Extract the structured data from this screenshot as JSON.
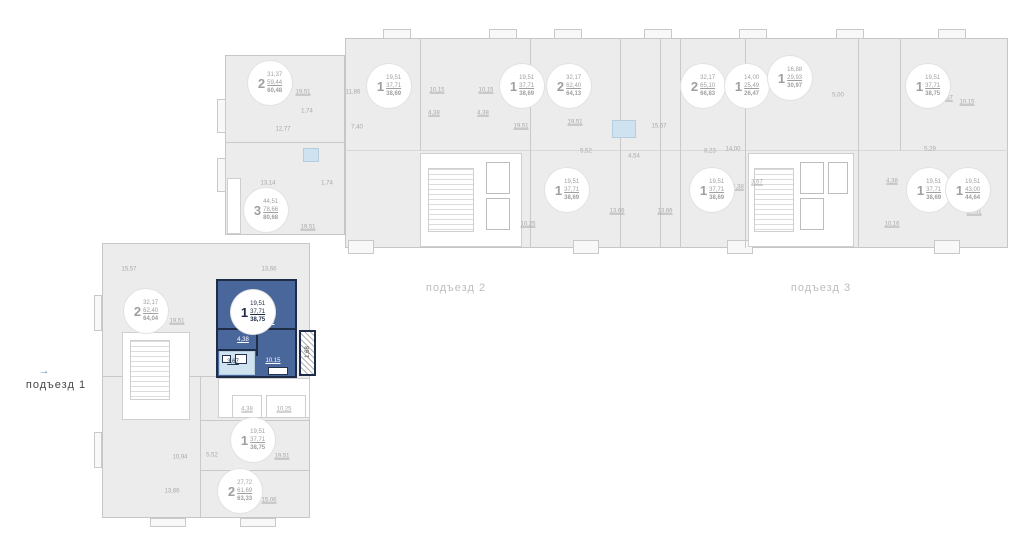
{
  "entrances": [
    {
      "label": "подъезд 1"
    },
    {
      "label": "подъезд 2"
    },
    {
      "label": "подъезд 3"
    }
  ],
  "arrow_icon": "→",
  "badges": [
    {
      "rooms": "2",
      "v1": "31,37",
      "v2": "59,44",
      "v3": "60,48"
    },
    {
      "rooms": "1",
      "v1": "19,51",
      "v2": "37,71",
      "v3": "38,69"
    },
    {
      "rooms": "1",
      "v1": "19,51",
      "v2": "37,71",
      "v3": "38,69"
    },
    {
      "rooms": "2",
      "v1": "32,17",
      "v2": "62,40",
      "v3": "64,13"
    },
    {
      "rooms": "2",
      "v1": "32,17",
      "v2": "65,10",
      "v3": "66,83"
    },
    {
      "rooms": "1",
      "v1": "14,00",
      "v2": "25,49",
      "v3": "26,47"
    },
    {
      "rooms": "1",
      "v1": "16,88",
      "v2": "29,93",
      "v3": "30,97"
    },
    {
      "rooms": "1",
      "v1": "19,51",
      "v2": "37,71",
      "v3": "38,75"
    },
    {
      "rooms": "3",
      "v1": "44,51",
      "v2": "78,66",
      "v3": "80,68"
    },
    {
      "rooms": "1",
      "v1": "19,51",
      "v2": "37,71",
      "v3": "38,69"
    },
    {
      "rooms": "1",
      "v1": "19,51",
      "v2": "37,71",
      "v3": "38,69"
    },
    {
      "rooms": "1",
      "v1": "19,51",
      "v2": "37,71",
      "v3": "38,69"
    },
    {
      "rooms": "1",
      "v1": "19,51",
      "v2": "43,00",
      "v3": "44,64"
    },
    {
      "rooms": "2",
      "v1": "32,17",
      "v2": "62,40",
      "v3": "64,04"
    },
    {
      "rooms": "1",
      "v1": "19,51",
      "v2": "37,71",
      "v3": "38,75"
    },
    {
      "rooms": "2",
      "v1": "27,72",
      "v2": "61,69",
      "v3": "63,33"
    }
  ],
  "selected_apartment": {
    "rooms": "1",
    "v1": "19,51",
    "v2": "37,71",
    "v3": "38,75",
    "living_area": "19,51",
    "hall_area": "4,38",
    "bath_area": "3,67",
    "kitchen_area": "10,15",
    "balcony_area": "1,68"
  },
  "dims": [
    {
      "t": "19,51"
    },
    {
      "t": "12,77"
    },
    {
      "t": "1,74"
    },
    {
      "t": "13,14"
    },
    {
      "t": "1,74"
    },
    {
      "t": "19,51"
    },
    {
      "t": "11,86"
    },
    {
      "t": "7,40"
    },
    {
      "t": "10,15"
    },
    {
      "t": "4,38"
    },
    {
      "t": "10,15"
    },
    {
      "t": "4,38"
    },
    {
      "t": "19,51"
    },
    {
      "t": "19,51"
    },
    {
      "t": "5,52"
    },
    {
      "t": "4,54"
    },
    {
      "t": "13,66"
    },
    {
      "t": "13,66"
    },
    {
      "t": "15,67"
    },
    {
      "t": "8,23"
    },
    {
      "t": "14,00"
    },
    {
      "t": "5,00"
    },
    {
      "t": "5,29"
    },
    {
      "t": "10,15"
    },
    {
      "t": "3,67"
    },
    {
      "t": "4,38"
    },
    {
      "t": "3,67"
    },
    {
      "t": "4,38"
    },
    {
      "t": "10,16"
    },
    {
      "t": "19,51"
    },
    {
      "t": "15,57"
    },
    {
      "t": "13,66"
    },
    {
      "t": "19,51"
    },
    {
      "t": "4,38"
    },
    {
      "t": "10,25"
    },
    {
      "t": "19,51"
    },
    {
      "t": "5,52"
    },
    {
      "t": "10,94"
    },
    {
      "t": "13,66"
    },
    {
      "t": "15,06"
    },
    {
      "t": "10,25"
    }
  ],
  "colors": {
    "highlight_fill": "#4a679c",
    "highlight_border": "#1e2c47",
    "bathroom_fill": "#cfe2ef",
    "plan_gray": "#ececec",
    "accent_blue": "#6a93cf"
  }
}
